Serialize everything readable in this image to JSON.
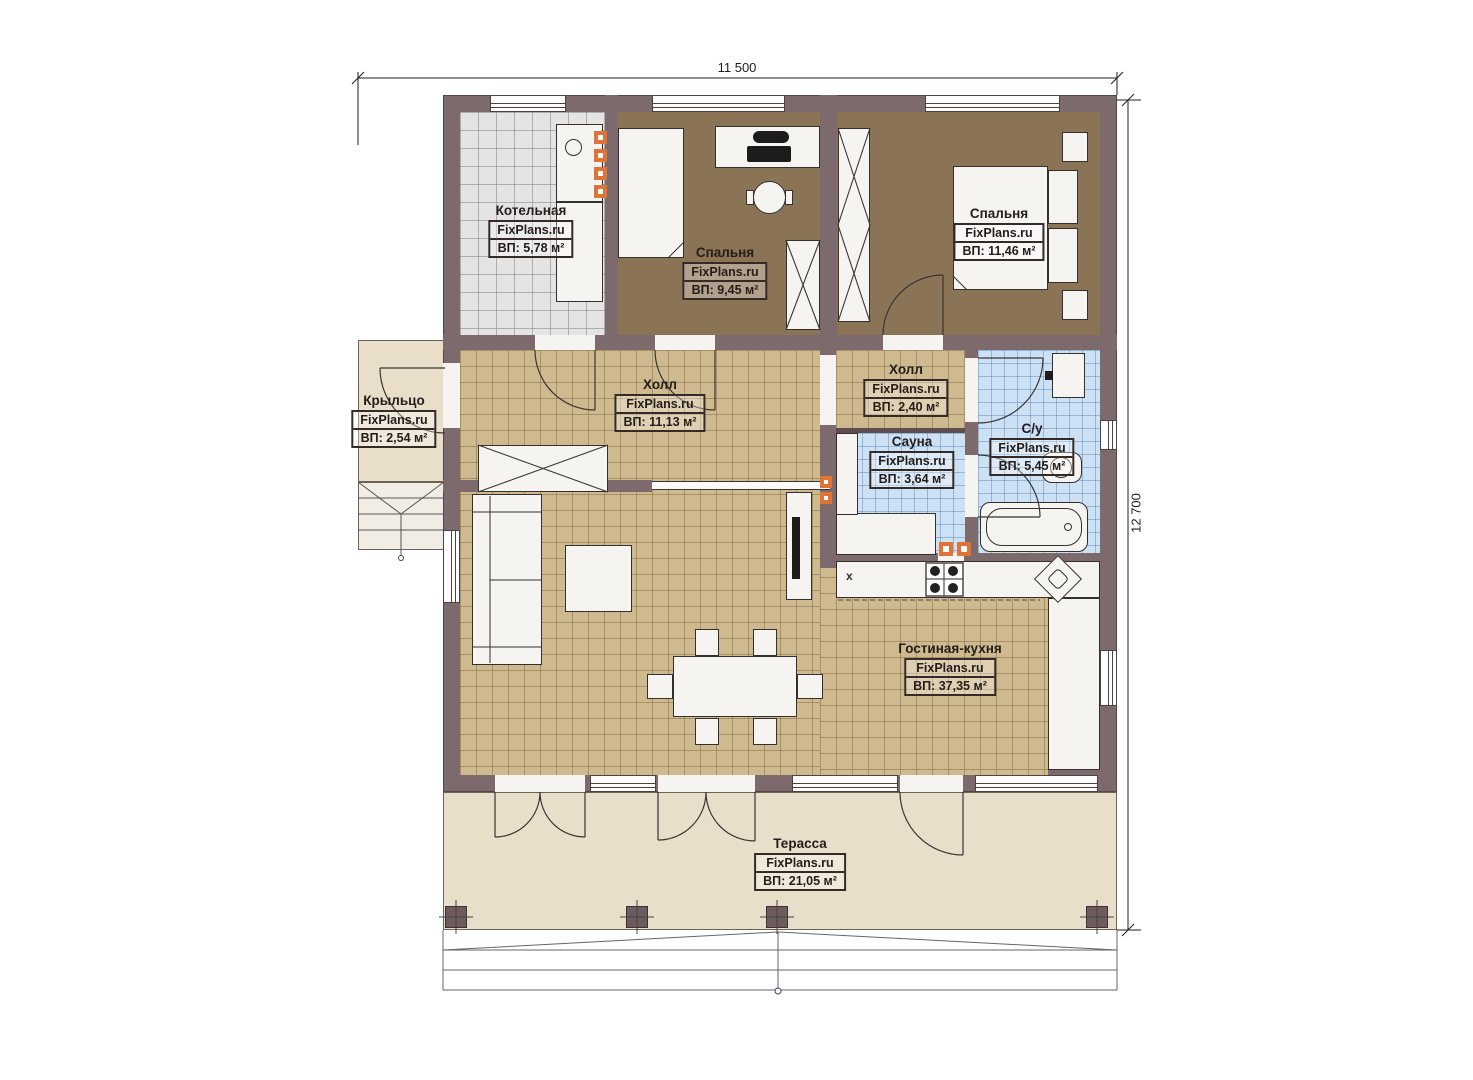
{
  "watermark": "FixPlans.ru",
  "dimensions": {
    "width": "11 500",
    "height": "12 700"
  },
  "rooms": {
    "boiler": {
      "name": "Котельная",
      "area": "ВП: 5,78 м²"
    },
    "bedroom1": {
      "name": "Спальня",
      "area": "ВП: 9,45 м²"
    },
    "bedroom2": {
      "name": "Спальня",
      "area": "ВП: 11,46 м²"
    },
    "porch": {
      "name": "Крыльцо",
      "area": "ВП: 2,54 м²"
    },
    "hall": {
      "name": "Холл",
      "area": "ВП: 11,13 м²"
    },
    "hall2": {
      "name": "Холл",
      "area": "ВП: 2,40 м²"
    },
    "sauna": {
      "name": "Сауна",
      "area": "ВП: 3,64 м²"
    },
    "bathroom": {
      "name": "С/у",
      "area": "ВП: 5,45 м²"
    },
    "living": {
      "name": "Гостиная-кухня",
      "area": "ВП: 37,35 м²"
    },
    "terrace": {
      "name": "Терасса",
      "area": "ВП: 21,05 м²"
    }
  },
  "markers": {
    "fridge": "x"
  },
  "colors": {
    "wall": "#7d6a6c",
    "floor_tan": "#cfba90",
    "floor_brown": "#8b7356",
    "floor_grey": "#e4e4e4",
    "floor_blue": "#cde1f5",
    "floor_porch": "#e9dec9",
    "accent_orange": "#df7436"
  }
}
